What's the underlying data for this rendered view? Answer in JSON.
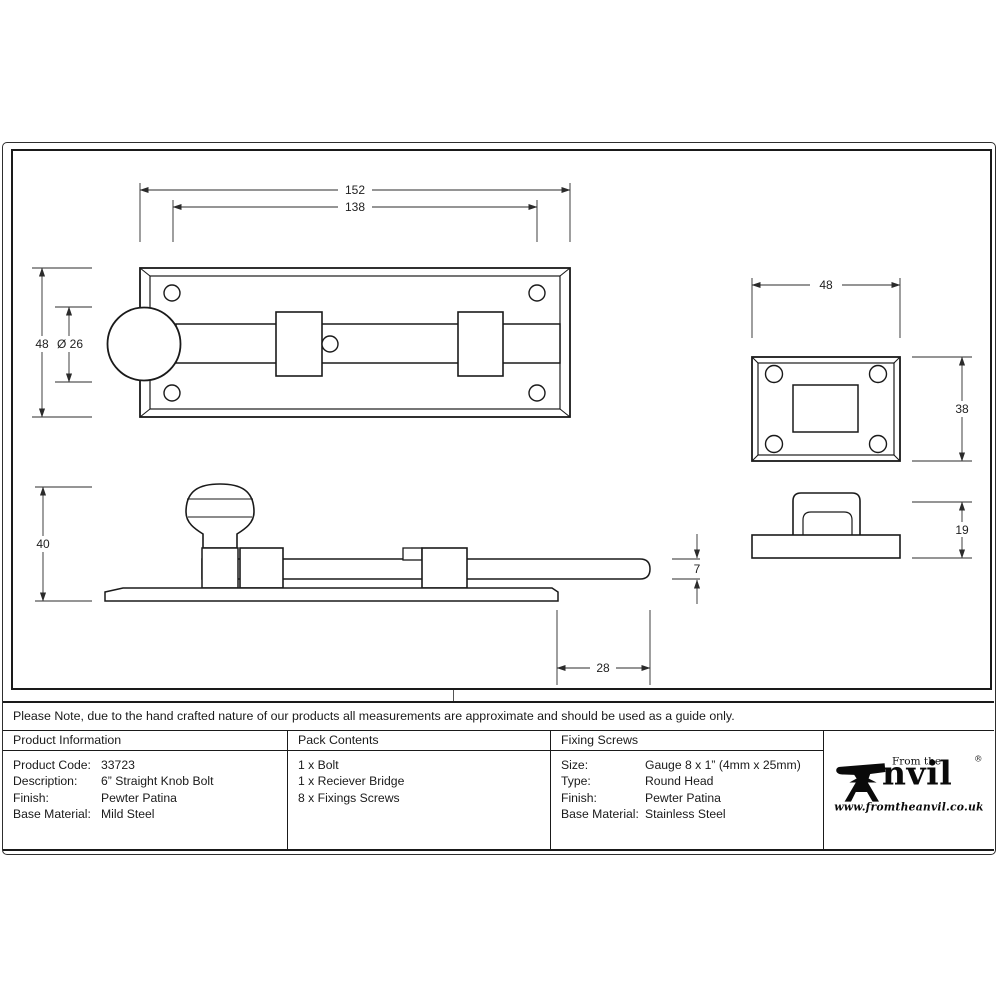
{
  "note": "Please Note, due to the hand crafted nature of our products all measurements are approximate and should be used as a guide only.",
  "dimensions": {
    "plate_length": "152",
    "hole_spacing": "138",
    "plate_width": "48",
    "knob_diameter": "Ø 26",
    "receiver_width": "48",
    "receiver_height": "38",
    "side_height": "40",
    "bolt_thickness": "7",
    "bolt_extension": "28",
    "bridge_height": "19"
  },
  "table": {
    "product_information": {
      "title": "Product Information",
      "rows": [
        {
          "label": "Product Code:",
          "value": "33723"
        },
        {
          "label": "Description:",
          "value": "6” Straight Knob Bolt"
        },
        {
          "label": "Finish:",
          "value": "Pewter Patina"
        },
        {
          "label": "Base Material:",
          "value": "Mild Steel"
        }
      ]
    },
    "pack_contents": {
      "title": "Pack Contents",
      "items": [
        "1 x Bolt",
        "1 x Reciever Bridge",
        "8 x Fixings Screws"
      ]
    },
    "fixing_screws": {
      "title": "Fixing Screws",
      "rows": [
        {
          "label": "Size:",
          "value": "Gauge 8 x 1” (4mm x 25mm)"
        },
        {
          "label": "Type:",
          "value": "Round Head"
        },
        {
          "label": "Finish:",
          "value": "Pewter Patina"
        },
        {
          "label": "Base Material:",
          "value": "Stainless Steel"
        }
      ]
    }
  },
  "logo": {
    "prefix": "From the",
    "name_rest": "nvil",
    "registered": "®",
    "website": "www.fromtheanvil.co.uk"
  },
  "colors": {
    "line": "#1a1a1a",
    "background": "#ffffff"
  }
}
